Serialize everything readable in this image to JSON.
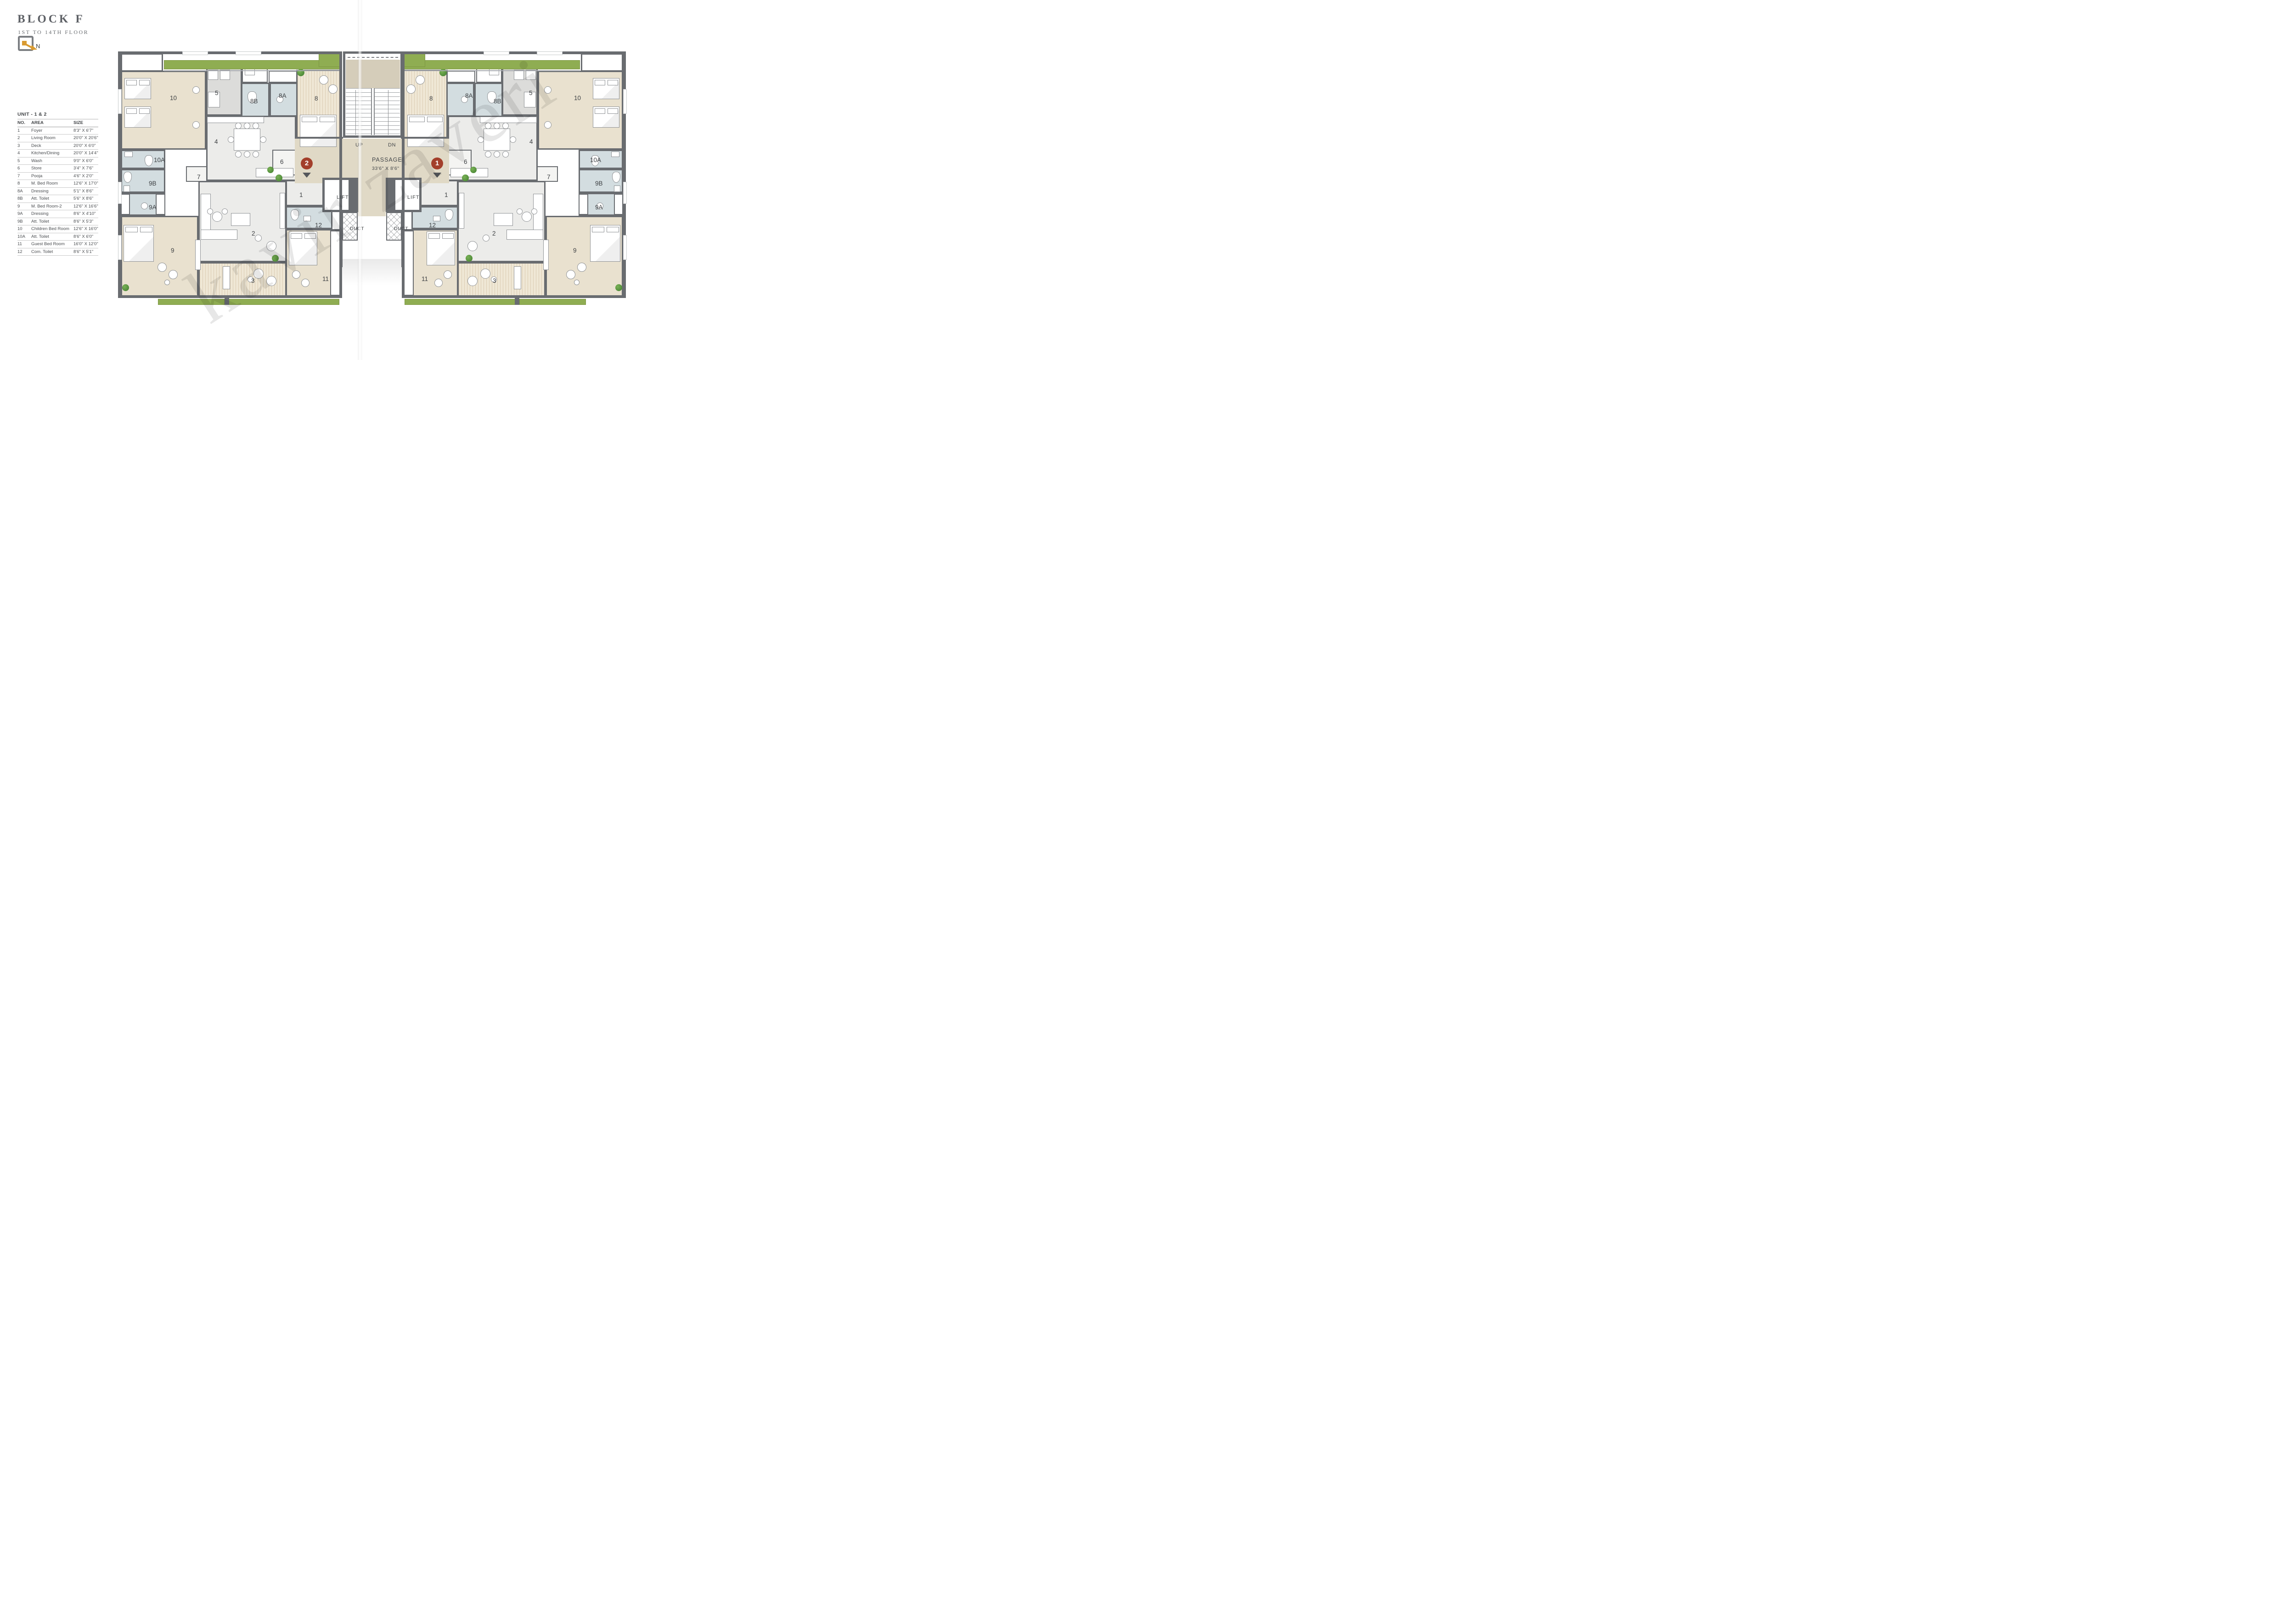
{
  "title": {
    "block": "BLOCK F",
    "floors": "1ST TO 14TH FLOOR",
    "north": "N"
  },
  "legend": {
    "title": "UNIT - 1 & 2",
    "headers": [
      "NO.",
      "AREA",
      "SIZE"
    ],
    "rows": [
      [
        "1",
        "Foyer",
        "8'3\" X 6'7\""
      ],
      [
        "2",
        "Living Room",
        "20'0\" X 20'6\""
      ],
      [
        "3",
        "Deck",
        "20'0\" X 6'0\""
      ],
      [
        "4",
        "Kitchen/Dining",
        "20'0\" X 14'4\""
      ],
      [
        "5",
        "Wash",
        "9'0\" X 6'0\""
      ],
      [
        "6",
        "Store",
        "3'4\" X 7'6\""
      ],
      [
        "7",
        "Pooja",
        "4'6\" X 2'0\""
      ],
      [
        "8",
        "M. Bed Room",
        "12'6\" X 17'0\""
      ],
      [
        "8A",
        "Dressing",
        "5'1\" X 8'6\""
      ],
      [
        "8B",
        "Att. Toilet",
        "5'6\" X 8'6\""
      ],
      [
        "9",
        "M. Bed Room-2",
        "12'6\" X 16'6\""
      ],
      [
        "9A",
        "Dressing",
        "8'6\" X 4'10\""
      ],
      [
        "9B",
        "Att. Toilet",
        "8'6\" X 5'3\""
      ],
      [
        "10",
        "Children Bed Room",
        "12'6\" X 16'0\""
      ],
      [
        "10A",
        "Att. Toilet",
        "8'6\" X 6'0\""
      ],
      [
        "11",
        "Guest Bed Room",
        "16'0\" X 12'0\""
      ],
      [
        "12",
        "Com. Toilet",
        "8'6\" X 5'1\""
      ]
    ]
  },
  "plan": {
    "stairs": {
      "up": "UP",
      "dn": "DN"
    },
    "passage": {
      "name": "PASSAGE",
      "size": "33'6\" X 8'6\""
    },
    "lift": "LIFT",
    "duct": "DUCT",
    "unit_markers": {
      "left": "2",
      "right": "1"
    },
    "rooms": {
      "foyer": "1",
      "living": "2",
      "deck": "3",
      "kitchen": "4",
      "wash": "5",
      "store": "6",
      "pooja": "7",
      "mbr": "8",
      "mbr-dress": "8A",
      "mbr-toilet": "8B",
      "mbr2": "9",
      "mbr2-dress": "9A",
      "mbr2-toilet": "9B",
      "children": "10",
      "children-toilet": "10A",
      "guest": "11",
      "com-toilet": "12"
    }
  },
  "watermark": "kavir zaveri",
  "colors": {
    "wall": "#696c70",
    "bedroom": "#e9e1cf",
    "toilet": "#d3dde0",
    "living": "#ececea",
    "service": "#dcdcda",
    "passage": "#e0d9c6",
    "landing": "#d5cdba",
    "green": "#8fad52",
    "plant": "#4e8f3a",
    "marker": "#a33f2b",
    "texture": "#efe7d5"
  }
}
